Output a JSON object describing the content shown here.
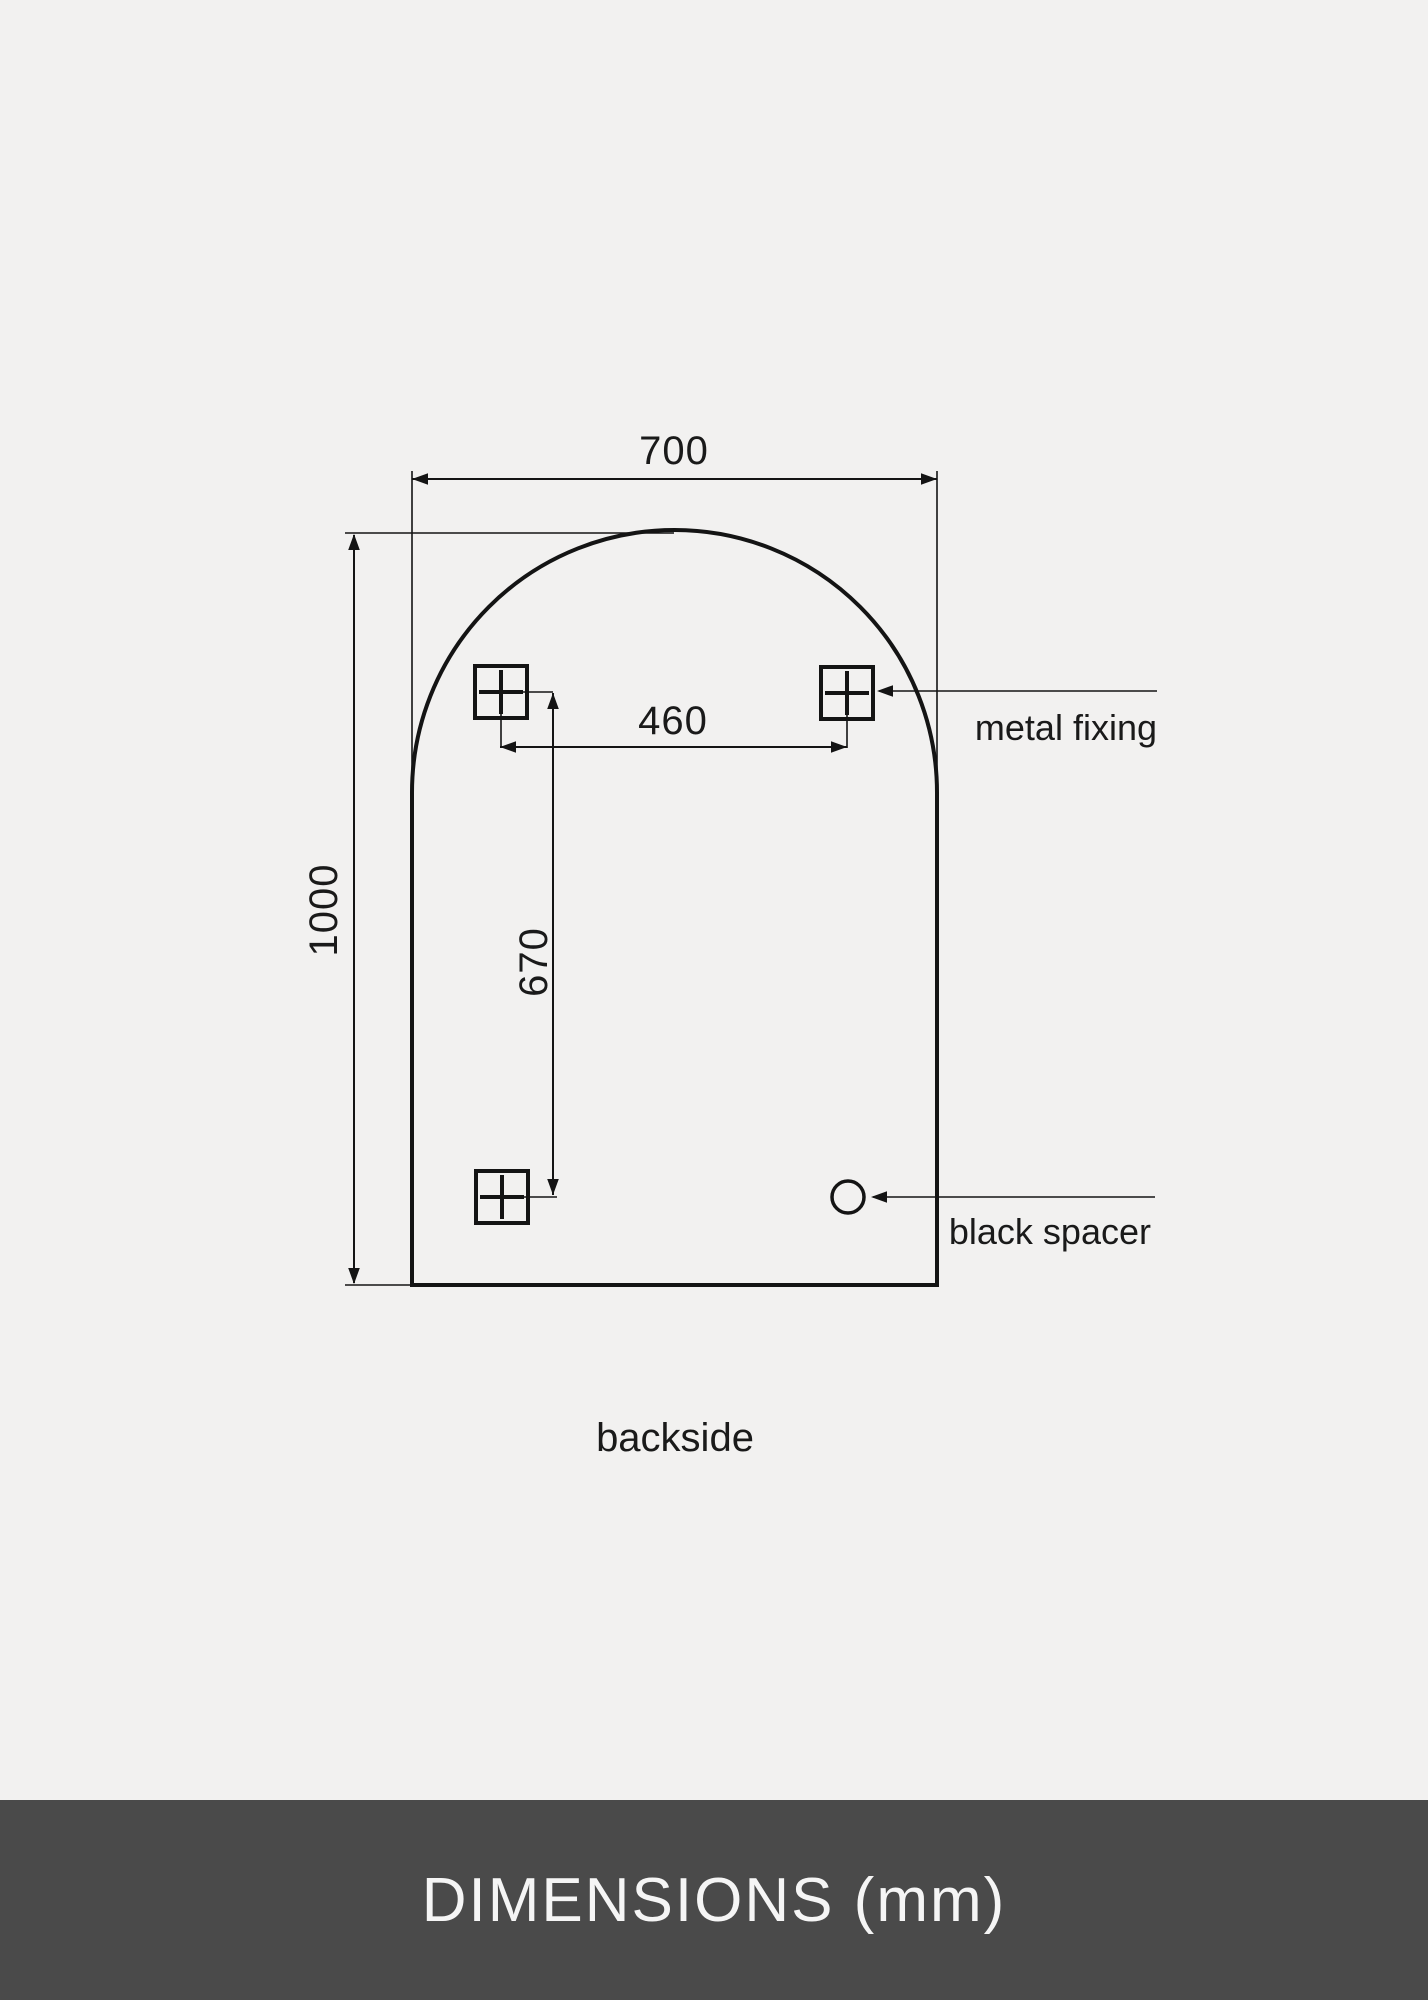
{
  "page": {
    "background_color": "#f2f1f0",
    "line_color": "#141414",
    "text_color": "#1a1a1a"
  },
  "drawing": {
    "dimensions": {
      "mirror_width_mm": "700",
      "mirror_height_mm": "1000",
      "fixing_spacing_horizontal_mm": "460",
      "fixing_spacing_vertical_mm": "670"
    },
    "annotations": {
      "metal_fixing_label": "metal fixing",
      "black_spacer_label": "black spacer",
      "backside_label": "backside"
    }
  },
  "footer": {
    "title": "DIMENSIONS (mm)",
    "background_color": "#4a4a4a",
    "text_color": "#f5f5f5"
  }
}
